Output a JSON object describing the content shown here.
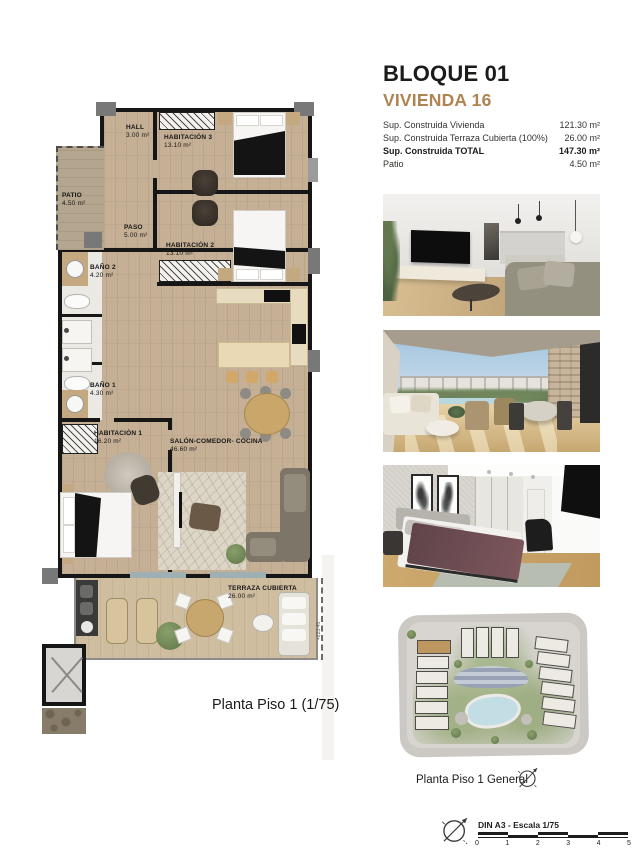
{
  "header": {
    "block_title": "BLOQUE 01",
    "unit_title": "VIVIENDA 16",
    "accent_color": "#b08352",
    "surface_table": [
      {
        "label": "Sup. Construida Vivienda",
        "value": "121.30 m²"
      },
      {
        "label": "Sup. Construida Terraza Cubierta (100%)",
        "value": "26.00 m²"
      },
      {
        "label": "Sup. Construida TOTAL",
        "value": "147.30 m²"
      },
      {
        "label": "Patio",
        "value": "4.50 m²"
      }
    ]
  },
  "floorplan": {
    "caption": "Planta Piso 1 (1/75)",
    "elevation_marker": "+223.45",
    "rooms": [
      {
        "name": "HALL",
        "area": "3.00 m²"
      },
      {
        "name": "HABITACIÓN 3",
        "area": "13.10 m²"
      },
      {
        "name": "PATIO",
        "area": "4.50 m²"
      },
      {
        "name": "PASO",
        "area": "5.00 m²"
      },
      {
        "name": "HABITACIÓN 2",
        "area": "13.10 m²"
      },
      {
        "name": "BAÑO 2",
        "area": "4.20 m²"
      },
      {
        "name": "BAÑO 1",
        "area": "4.30 m²"
      },
      {
        "name": "HABITACIÓN 1",
        "area": "16.20 m²"
      },
      {
        "name": "SALÓN-COMEDOR- COCINA",
        "area": "46.60 m²"
      },
      {
        "name": "TERRAZA CUBIERTA",
        "area": "26.00 m²"
      }
    ]
  },
  "photos": [
    {
      "name": "living-room-render"
    },
    {
      "name": "terrace-render"
    },
    {
      "name": "bedroom-render"
    }
  ],
  "siteplan": {
    "caption": "Planta Piso 1 General"
  },
  "footer": {
    "scale_label": "DIN A3 - Escala 1/75",
    "scale_ticks": [
      "0",
      "1",
      "2",
      "3",
      "4",
      "5"
    ]
  }
}
